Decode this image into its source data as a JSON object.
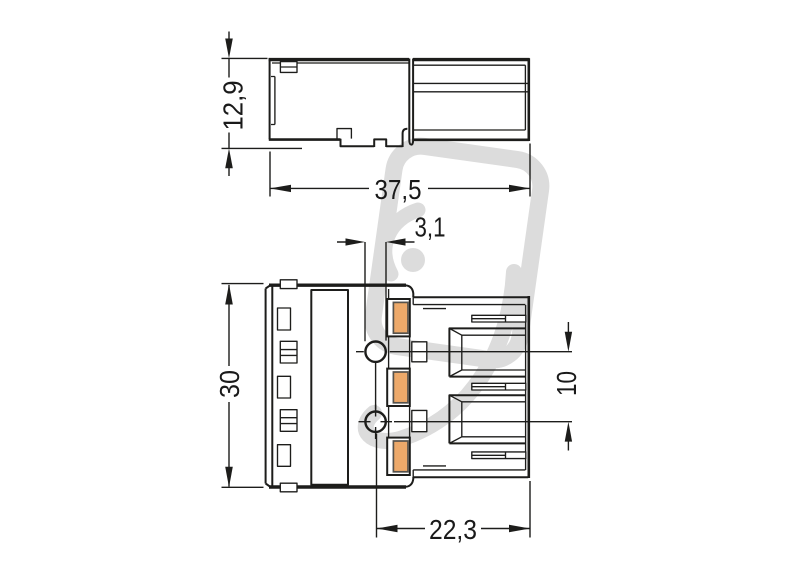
{
  "drawing": {
    "title": "connector-technical-drawing",
    "side_view": {
      "height_label": "12,9",
      "width_label": "37,5"
    },
    "front_view": {
      "hole_diameter_label": "3,1",
      "height_label": "30",
      "pitch_label": "10",
      "width_label": "22,3"
    }
  },
  "colors": {
    "line": "#1d1d1b",
    "text": "#1a1a1a",
    "contact_fill": "#eda96a",
    "watermark": "#dcdcdc",
    "background": "#ffffff"
  }
}
